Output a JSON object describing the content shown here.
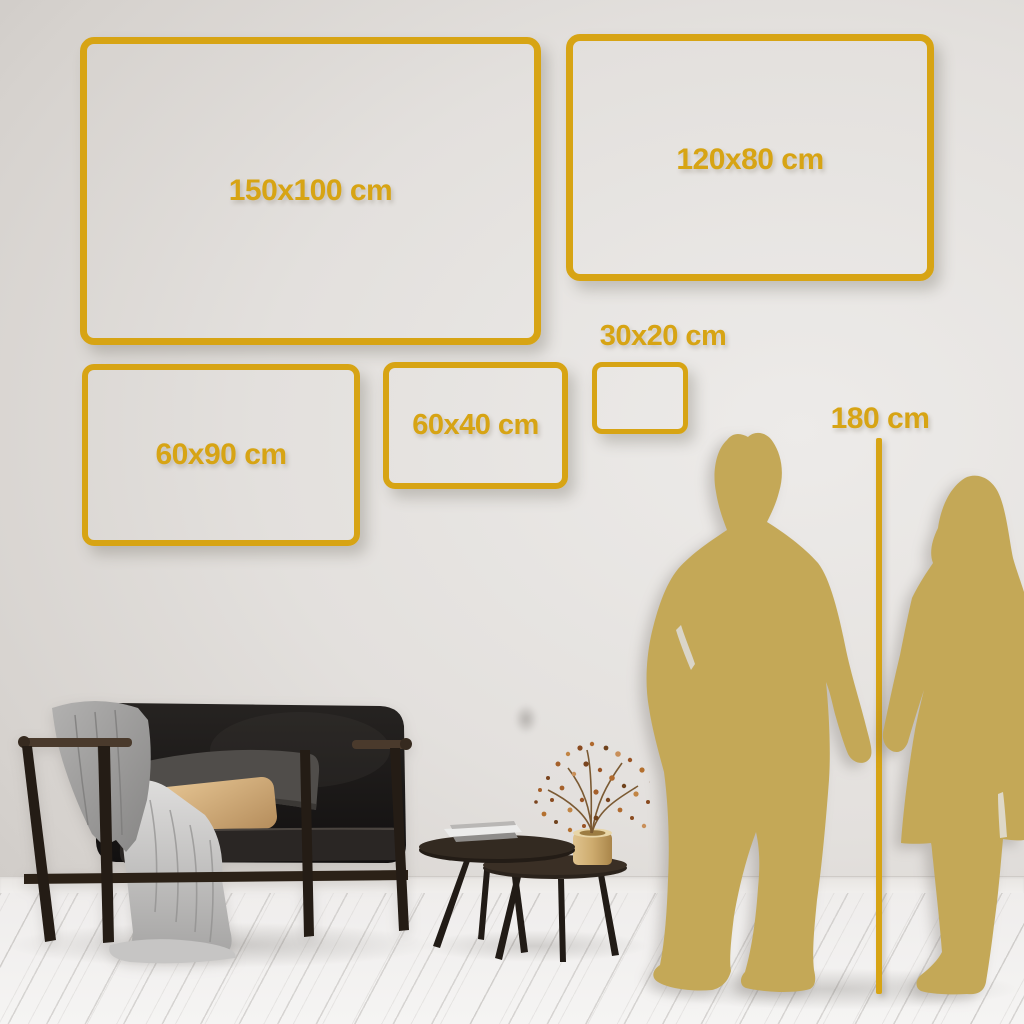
{
  "frames": [
    {
      "name": "150x100",
      "label": "150x100 cm"
    },
    {
      "name": "120x80",
      "label": "120x80 cm"
    },
    {
      "name": "60x90",
      "label": "60x90 cm"
    },
    {
      "name": "60x40",
      "label": "60x40 cm"
    },
    {
      "name": "30x20",
      "label": "30x20 cm"
    }
  ],
  "height_marker": {
    "label": "180 cm"
  },
  "colors": {
    "frame_gold": "#D7A414",
    "silhouette_gold": "#C4A857",
    "wall": "#DDD9D6",
    "floor": "#F3F2F1"
  },
  "icons": [
    "couple-holding-hands-silhouette",
    "height-reference-line",
    "sofa-with-throw-blanket",
    "nesting-coffee-tables",
    "book-stack",
    "brass-vase-with-dried-plant"
  ]
}
